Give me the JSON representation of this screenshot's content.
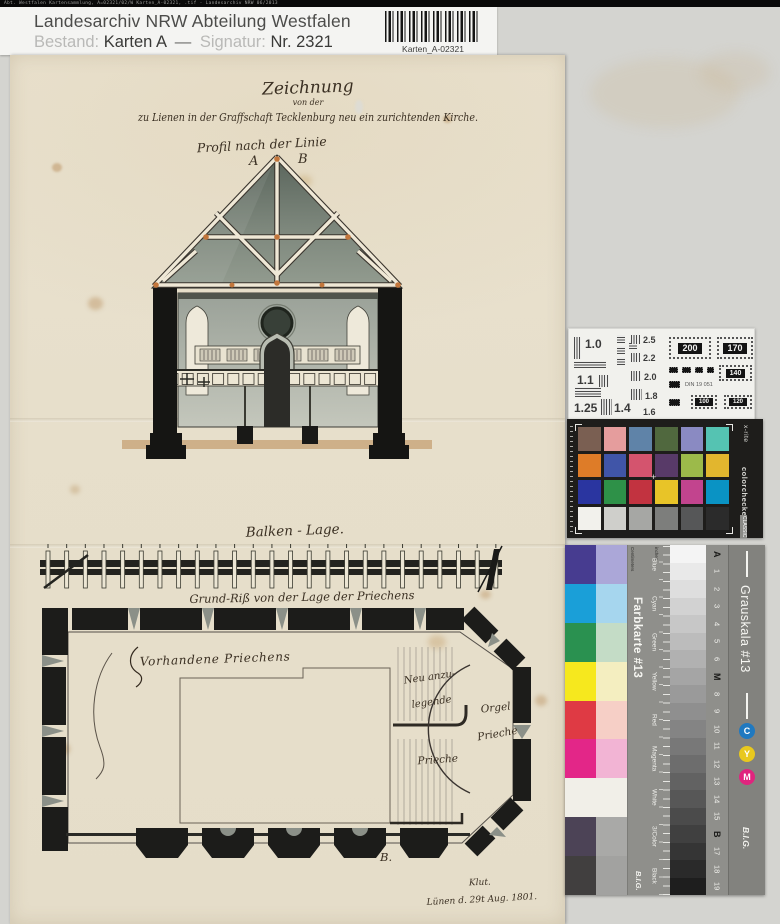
{
  "file_strip": "Abt. Westfalen Kartensammlung, A=02321/02/W  Karten_A-02321, .tif  -  Landesarchiv NRW  06/2013",
  "header": {
    "archive": "Landesarchiv NRW Abteilung Westfalen",
    "bestand_label": "Bestand:",
    "bestand_value": "Karten A",
    "separator": "—",
    "signatur_label": "Signatur:",
    "signatur_value": "Nr. 2321",
    "barcode_label": "Karten_A-02321"
  },
  "drawing": {
    "title_line1": "Zeichnung",
    "title_line2": "von der",
    "title_line3": "zu Lienen in der Graffschaft Tecklenburg neu ein zurichtenden Kirche.",
    "profil_caption": "Profil nach der Linie",
    "marker_a": "A",
    "marker_b": "B",
    "balken_caption": "Balken - Lage.",
    "grundriss_caption": "Grund-Riß von der Lage der Priechens",
    "plan_labels": {
      "existing": "Vorhandene Priechens",
      "new_line1": "Neu anzu-",
      "new_line2": "legende",
      "orgel_line1": "Orgel",
      "orgel_line2": "Prieche",
      "prieche": "Prieche",
      "marker_b_plan": "B."
    },
    "signature_line1": "Klut.",
    "signature_line2": "Lünen d. 29t Aug. 1801."
  },
  "resolution_chart": {
    "din_label": "DIN 19 051",
    "left_values": [
      "1.0",
      "1.1",
      "1.25",
      "1.4",
      "1.6",
      "1.8",
      "2.0",
      "2.2",
      "2.5"
    ],
    "right_values": [
      "200",
      "170",
      "140",
      "100",
      "120"
    ]
  },
  "colorchecker": {
    "brand": "x-rite",
    "product": "colorchecker",
    "badge": "CLASSIC",
    "patches": [
      "#7a5f52",
      "#e59d9d",
      "#5f83a8",
      "#50683e",
      "#8a8ac2",
      "#55c3b2",
      "#de7c28",
      "#4055a8",
      "#d4546e",
      "#583a68",
      "#9cba4a",
      "#e2b62e",
      "#2a35a0",
      "#2e9148",
      "#c23340",
      "#e8c428",
      "#c2448e",
      "#0a93c4",
      "#f2f1ec",
      "#cfcfcb",
      "#a6a7a4",
      "#7d7e7c",
      "#565758",
      "#2b2b2b"
    ]
  },
  "farbkarte": {
    "title": "Farbkarte #13",
    "brand": "B.I.G.",
    "unit_left": "Centimeters",
    "unit_right": "inches",
    "rows": [
      {
        "label": "Blue",
        "strong": "#473c90",
        "pale": "#aba7d8"
      },
      {
        "label": "Cyan",
        "strong": "#1a9fd8",
        "pale": "#a6d6ee"
      },
      {
        "label": "Green",
        "strong": "#2a9150",
        "pale": "#c4dcc6"
      },
      {
        "label": "Yellow",
        "strong": "#f6e81e",
        "pale": "#f4eec0"
      },
      {
        "label": "Red",
        "strong": "#df3a44",
        "pale": "#f6cfc6"
      },
      {
        "label": "Magenta",
        "strong": "#e32688",
        "pale": "#f2b4d4"
      },
      {
        "label": "White",
        "strong": "#f1efe8",
        "pale": "#f1efe8"
      },
      {
        "label": "3/Color",
        "strong": "#4c4356",
        "pale": "#a9a9a7"
      },
      {
        "label": "Black",
        "strong": "#413f3f",
        "pale": "#a2a2a0"
      }
    ]
  },
  "grauskala": {
    "title": "Grauskala #13",
    "brand": "B.I.G.",
    "steps": [
      "#f4f4f4",
      "#e9e9e9",
      "#dedede",
      "#d2d2d2",
      "#c7c7c7",
      "#bcbcbc",
      "#b1b1b1",
      "#a5a5a5",
      "#9a9a9a",
      "#8f8f8f",
      "#848484",
      "#787878",
      "#6d6d6d",
      "#626262",
      "#575757",
      "#4b4b4b",
      "#404040",
      "#353535",
      "#2a2a2a",
      "#1e1e1e"
    ],
    "index_labels": [
      "A",
      "1",
      "2",
      "3",
      "4",
      "5",
      "6",
      "M",
      "8",
      "9",
      "10",
      "11",
      "12",
      "13",
      "14",
      "15",
      "B",
      "17",
      "18",
      "19"
    ],
    "cym": [
      "C",
      "Y",
      "M"
    ],
    "cym_colors": [
      "#2079c0",
      "#e8c81e",
      "#e0247e"
    ]
  }
}
